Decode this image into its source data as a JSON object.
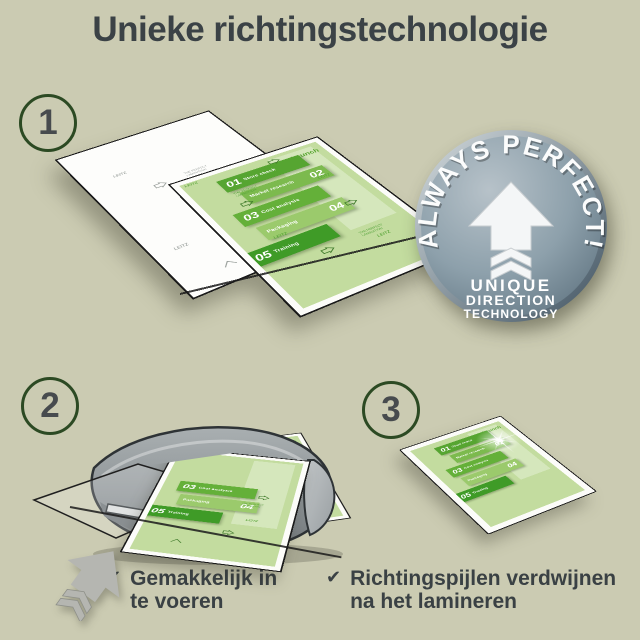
{
  "header": {
    "title": "Unieke richtingstechnologie"
  },
  "steps": [
    {
      "number": "1"
    },
    {
      "number": "2"
    },
    {
      "number": "3"
    }
  ],
  "badge": {
    "arc_text": "ALWAYS PERFECT!",
    "lines": [
      "UNIQUE",
      "DIRECTION",
      "TECHNOLOGY"
    ]
  },
  "document": {
    "items": [
      {
        "num": "01",
        "label": "Store check"
      },
      {
        "num": "02",
        "label": "Market research"
      },
      {
        "num": "03",
        "label": "Cost analysis"
      },
      {
        "num": "04",
        "label": "Packaging"
      },
      {
        "num": "05",
        "label": "Training"
      }
    ],
    "launch_label": "Launch",
    "watermark": "LEITZ",
    "fine_print": "THE PERFECT LAMINATION"
  },
  "checklist": [
    {
      "check": "✔",
      "lines": [
        "Gemakkelijk in",
        "te voeren"
      ]
    },
    {
      "check": "✔",
      "lines": [
        "Richtingspijlen verdwijnen",
        "na het lamineren"
      ]
    }
  ],
  "colors": {
    "background": "#cbcbb2",
    "heading_text": "#3b4246",
    "step_circle_outline": "#2c4a23",
    "step_number": "#474b4e",
    "band_greens": [
      "#56a531",
      "#7cba4e",
      "#64b039",
      "#9bca6c",
      "#3f9b27"
    ],
    "document_green": "#c3dc9f",
    "badge_steel": "#8da0ab",
    "machine_gray": "#8f9598",
    "feed_arrow_gray": "#b5b6b1",
    "check_text": "#3a4144"
  }
}
